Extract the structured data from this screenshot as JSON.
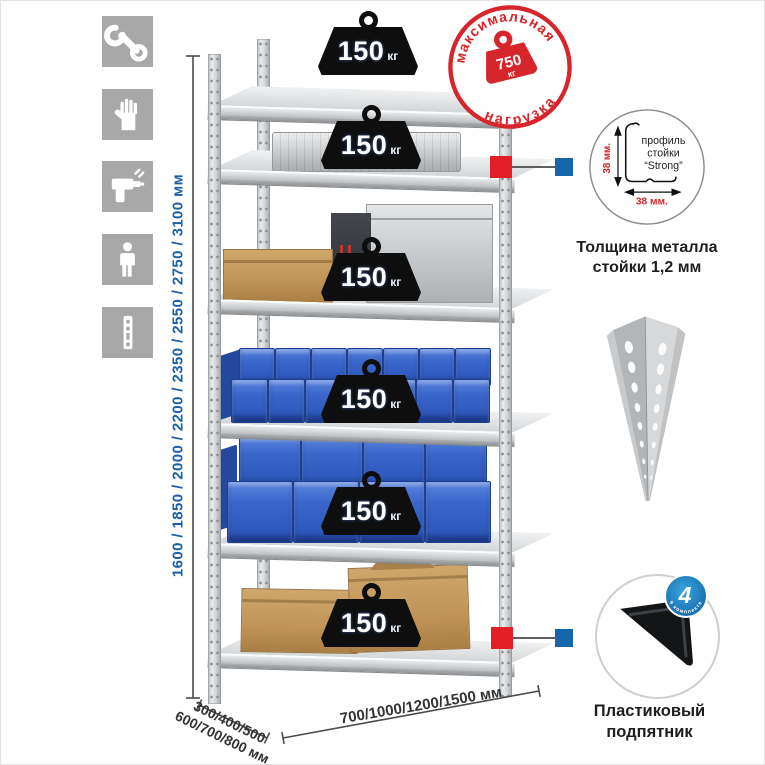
{
  "colors": {
    "accent_red": "#d6252b",
    "dimension_blue": "#1a5fa8",
    "bin_blue": "#2f5fc2",
    "badge_black": "#0e0e0e",
    "callout_red_square": "#e31e25",
    "callout_blue_square": "#1565ad",
    "metal_gray": "#cdd0d2",
    "icon_tile_gray": "#a8a8a8"
  },
  "sidebar": {
    "icons": [
      {
        "name": "wrench"
      },
      {
        "name": "gloves"
      },
      {
        "name": "drill"
      },
      {
        "name": "person"
      },
      {
        "name": "perforated-strip"
      }
    ]
  },
  "dimensions": {
    "height": "1600 / 1850 / 2000 / 2200 / 2350 / 2550 / 2750 / 3100 мм",
    "depth_line1": "300/400/500",
    "depth_line2": "600/700/800 мм",
    "width": "700/1000/1200/1500 мм"
  },
  "shelf_badges": [
    {
      "value": "150",
      "unit": "кг"
    },
    {
      "value": "150",
      "unit": "кг"
    },
    {
      "value": "150",
      "unit": "кг"
    },
    {
      "value": "150",
      "unit": "кг"
    },
    {
      "value": "150",
      "unit": "кг"
    },
    {
      "value": "150",
      "unit": "кг"
    }
  ],
  "max_load_stamp": {
    "arc_top": "максимальная",
    "arc_bottom": "нагрузка",
    "value": "750",
    "unit": "кг"
  },
  "profile_callout": {
    "label_line1": "профиль",
    "label_line2": "стойки",
    "label_line3": "“Strong”",
    "vertical_dim": "38 мм.",
    "horizontal_dim": "38 мм.",
    "caption_line1": "Толщина металла",
    "caption_line2": "стойки 1,2 мм"
  },
  "foot_callout": {
    "badge_value": "4",
    "badge_arc_text": "в комплекте",
    "caption_line1": "Пластиковый",
    "caption_line2": "подпятник"
  }
}
